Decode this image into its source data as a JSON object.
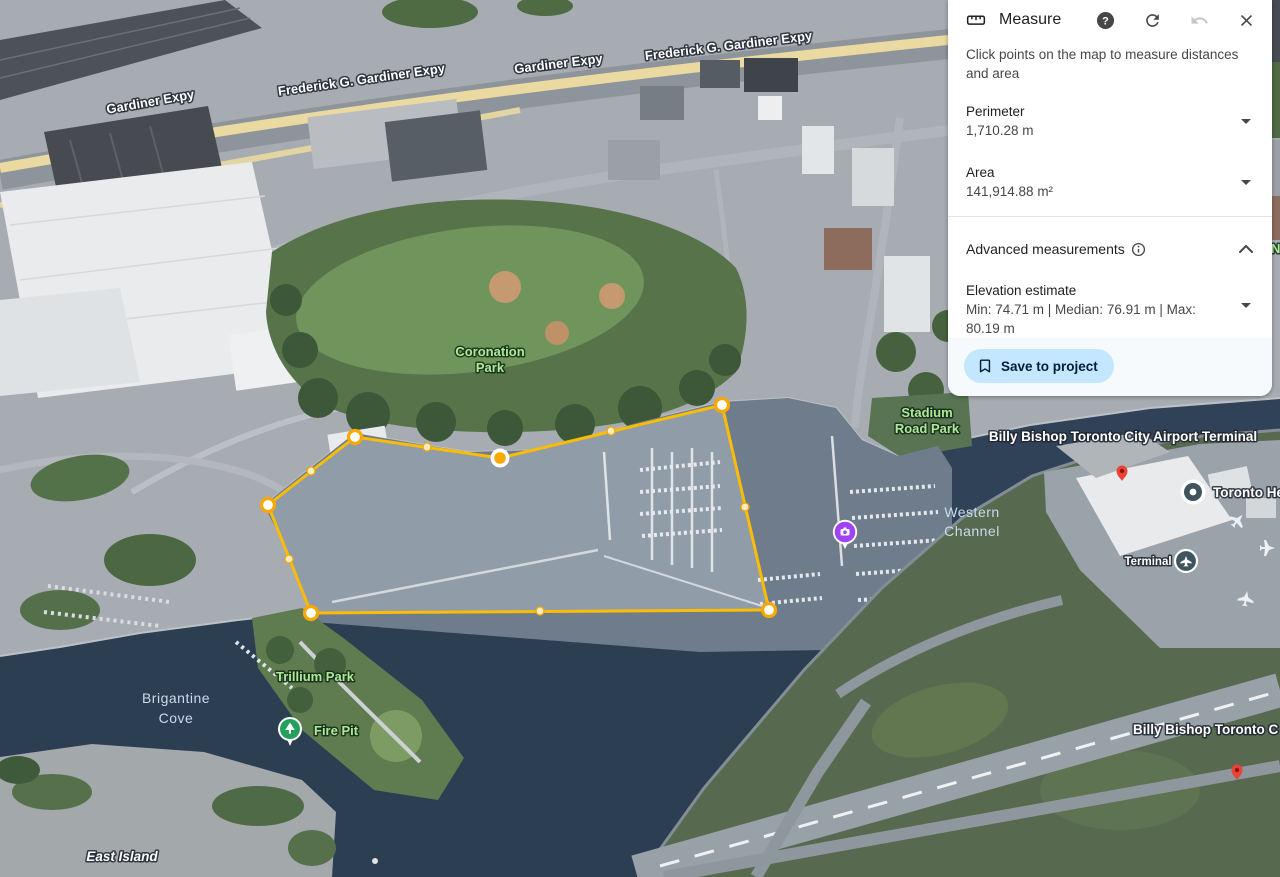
{
  "panel": {
    "title": "Measure",
    "instruction": "Click points on the map to measure distances and area",
    "sections": {
      "perimeter": {
        "label": "Perimeter",
        "value": "1,710.28 m"
      },
      "area": {
        "label": "Area",
        "value": "141,914.88 m²"
      },
      "advanced": {
        "label": "Advanced measurements"
      },
      "elevation": {
        "label": "Elevation estimate",
        "value": "Min: 74.71 m | Median: 76.91 m | Max: 80.19 m"
      }
    },
    "save_button": {
      "label": "Save to project"
    }
  },
  "map": {
    "labels": {
      "gardiner_w": "Gardiner Expy",
      "frederick_w": "Frederick G. Gardiner Expy",
      "gardiner_e": "Gardiner Expy",
      "frederick_e": "Frederick G. Gardiner Expy",
      "coronation_1": "Coronation",
      "coronation_2": "Park",
      "stadium_1": "Stadium",
      "stadium_2": "Road Park",
      "billy_terminal": "Billy Bishop Toronto City Airport Terminal",
      "western_1": "Western",
      "western_2": "Channel",
      "toronto_he": "Toronto He",
      "terminal": "Terminal",
      "brigantine_1": "Brigantine",
      "brigantine_2": "Cove",
      "trillium": "Trillium Park",
      "fire_pit": "Fire Pit",
      "east_island": "East Island",
      "billy_c": "Billy Bishop Toronto C",
      "n_fragment": "N"
    },
    "measurement": {
      "stroke_color": "#FBBC04",
      "vertices": [
        [
          355,
          437
        ],
        [
          500,
          458
        ],
        [
          722,
          405
        ],
        [
          769,
          610
        ],
        [
          311,
          613
        ],
        [
          268,
          505
        ]
      ],
      "selected_vertex_index": 1,
      "midpoints": [
        [
          427,
          447
        ],
        [
          611,
          431
        ],
        [
          745,
          507
        ],
        [
          540,
          611
        ],
        [
          289,
          559
        ],
        [
          311,
          471
        ]
      ]
    }
  },
  "colors": {
    "accent_yellow": "#FBBC04",
    "save_button_bg": "#c2e7ff",
    "save_button_text": "#001d35",
    "park_label": "#AEE99B",
    "water_label": "#C9DBEC",
    "highway_highlight": "#EAD9A0"
  }
}
